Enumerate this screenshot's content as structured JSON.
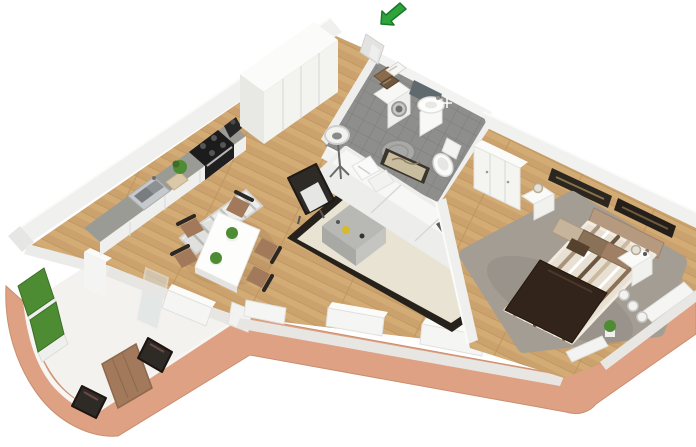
{
  "meta": {
    "scene": "isometric-3d-apartment-floor-plan",
    "view": "axonometric top-down render",
    "background": "#ffffff"
  },
  "colors": {
    "wood": "#cba26d",
    "wood_seam": "#b8905a",
    "exterior_wall": "#dfa183",
    "exterior_wall_edge": "#c98f6f",
    "interior_wall": "#f0f0ee",
    "terrace_floor": "#f3f2ee",
    "tile": "#8e8e8c",
    "tile_seam": "#7c7c7a",
    "rug_living": "#e9e3d3",
    "rug_living_border": "#26211b",
    "rug_bedroom": "#a39d94",
    "sofa": "#ededeb",
    "coffee_table": "#b8b8b4",
    "chair_dark": "#2e2a26",
    "wood_furniture": "#a2795a",
    "bed_throw": "#32241a",
    "bed_duvet": "#e8e0d2",
    "grass": "#4e8c33",
    "arrow_green": "#2fa33c",
    "glass": "#d7dfe1",
    "appliance_dark": "#1c1c1c",
    "rail_white": "#f6f6f4"
  },
  "entrance": {
    "indicator": "green-arrow",
    "meaning": "apartment entry direction"
  },
  "rooms": [
    {
      "id": "terrace",
      "name": "Terrace",
      "floor": "concrete",
      "furniture": [
        "wooden-table",
        "chair",
        "chair",
        "grass-planters",
        "curved-parapet"
      ]
    },
    {
      "id": "kitchen",
      "name": "Kitchen",
      "floor": "wood",
      "furniture": [
        "counter",
        "sink",
        "cooktop",
        "oven",
        "coffee-machine",
        "plant",
        "cutting-board",
        "tall-cabinets",
        "runner-rug"
      ]
    },
    {
      "id": "dining",
      "name": "Dining area",
      "floor": "wood",
      "furniture": [
        "white-table",
        "plant",
        "plant",
        "chair",
        "chair",
        "chair",
        "chair",
        "chair"
      ]
    },
    {
      "id": "living",
      "name": "Living room",
      "floor": "wood",
      "furniture": [
        "sofa",
        "pillows",
        "coffee-table",
        "armchair",
        "floor-lamp",
        "bordered-rug",
        "wall-art"
      ]
    },
    {
      "id": "bathroom",
      "name": "Bathroom",
      "floor": "tile",
      "furniture": [
        "washing-machine",
        "towel-shelf",
        "vanity-sink",
        "mirror",
        "toilet",
        "round-rug"
      ]
    },
    {
      "id": "bedroom",
      "name": "Bedroom",
      "floor": "wood",
      "furniture": [
        "double-bed",
        "headboard",
        "wardrobe",
        "nightstand",
        "nightstand",
        "lamp",
        "wall-frames",
        "gray-rug",
        "window-spheres",
        "plant"
      ]
    },
    {
      "id": "hall",
      "name": "Entrance hall",
      "floor": "wood",
      "furniture": []
    }
  ]
}
